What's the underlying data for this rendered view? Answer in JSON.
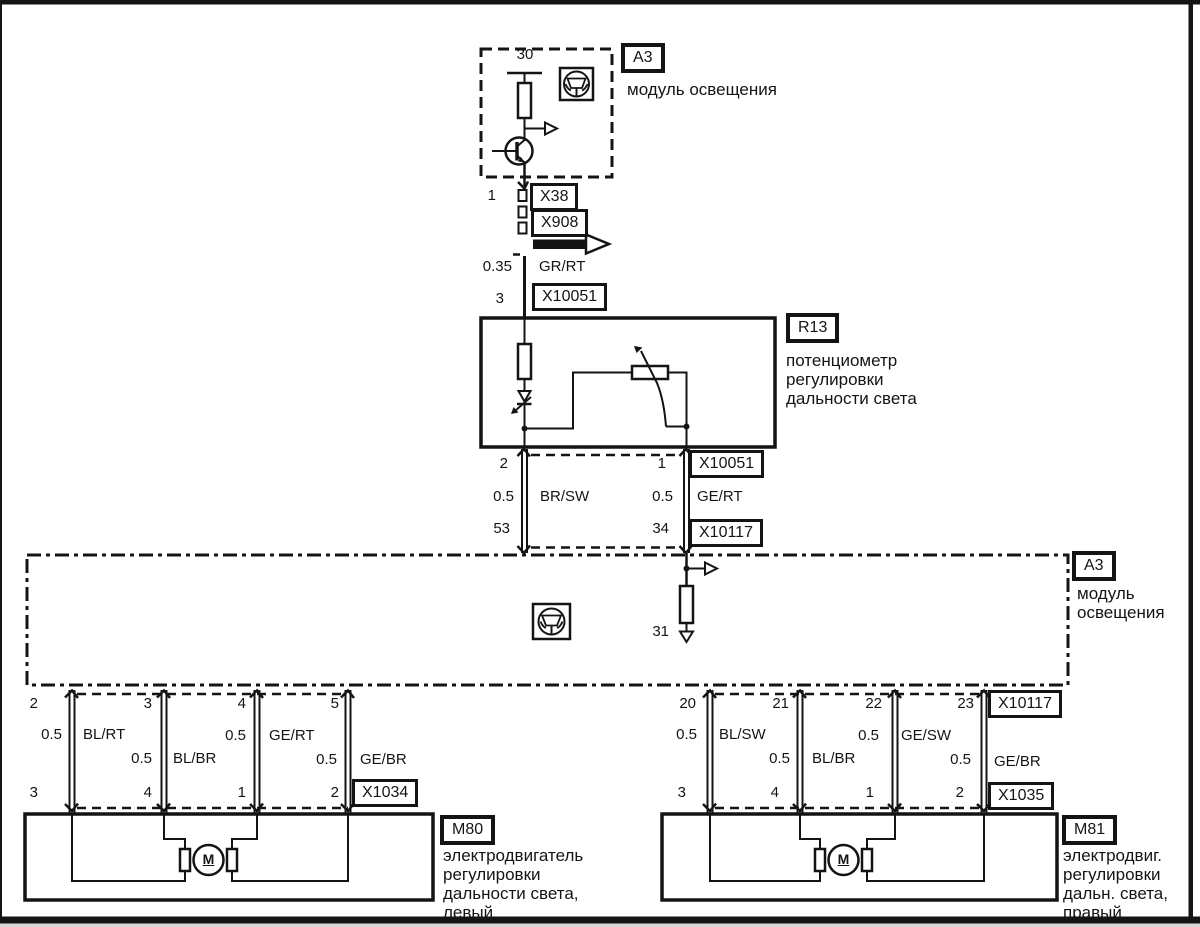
{
  "palette": {
    "ink": "#141414",
    "paper": "#ffffff"
  },
  "top_module": {
    "ref": "A3",
    "name": "модуль освещения",
    "terminal": "30",
    "pin": "1"
  },
  "top_connectors": {
    "x38": "X38",
    "x908": "X908"
  },
  "supply_wire": {
    "gauge": "0.35",
    "color": "GR/RT",
    "pin": "3",
    "connector": "X10051"
  },
  "potentiometer": {
    "ref": "R13",
    "name": "потенциометр\nрегулировки\nдальности света"
  },
  "mid_harness": {
    "connector_top": "X10051",
    "connector_bottom": "X10117",
    "left": {
      "pin_top": "2",
      "gauge": "0.5",
      "color": "BR/SW",
      "pin_bottom": "53"
    },
    "right": {
      "pin_top": "1",
      "gauge": "0.5",
      "color": "GE/RT",
      "pin_bottom": "34"
    }
  },
  "light_module": {
    "ref": "A3",
    "name": "модуль\nосвещения",
    "ground_pin": "31"
  },
  "left_branch": {
    "connector_bottom": "X1034",
    "wires": [
      {
        "pin_top": "2",
        "gauge": "0.5",
        "color": "BL/RT",
        "pin_bottom": "3"
      },
      {
        "pin_top": "3",
        "gauge": "0.5",
        "color": "BL/BR",
        "pin_bottom": "4"
      },
      {
        "pin_top": "4",
        "gauge": "0.5",
        "color": "GE/RT",
        "pin_bottom": "1"
      },
      {
        "pin_top": "5",
        "gauge": "0.5",
        "color": "GE/BR",
        "pin_bottom": "2"
      }
    ],
    "motor": {
      "ref": "M80",
      "symbol": "M",
      "name": "электродвигатель\nрегулировки\nдальности света,\nлевый"
    }
  },
  "right_branch": {
    "connector_top": "X10117",
    "connector_bottom": "X1035",
    "wires": [
      {
        "pin_top": "20",
        "gauge": "0.5",
        "color": "BL/SW",
        "pin_bottom": "3"
      },
      {
        "pin_top": "21",
        "gauge": "0.5",
        "color": "BL/BR",
        "pin_bottom": "4"
      },
      {
        "pin_top": "22",
        "gauge": "0.5",
        "color": "GE/SW",
        "pin_bottom": "1"
      },
      {
        "pin_top": "23",
        "gauge": "0.5",
        "color": "GE/BR",
        "pin_bottom": "2"
      }
    ],
    "motor": {
      "ref": "M81",
      "symbol": "M",
      "name": "электродвиг.\nрегулировки\nдальн. света,\nправый"
    }
  }
}
